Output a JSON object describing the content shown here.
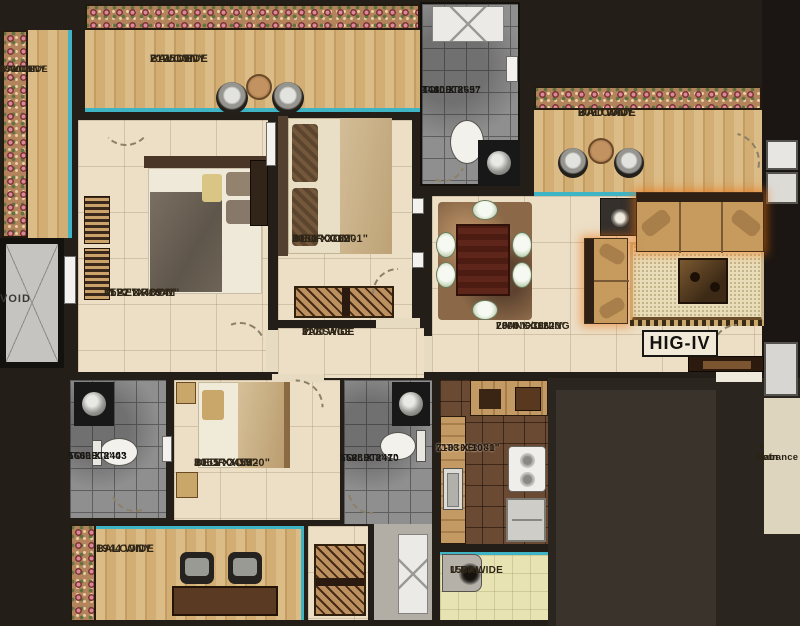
{
  "unit": {
    "type_label": "HIG-IV"
  },
  "entrance": {
    "arrow": "▲",
    "line1": "Main",
    "line2": "Entrance",
    "line3": "Door"
  },
  "rooms": {
    "balcony_top_left": {
      "name": "BALCONY",
      "dim_mm": "2125 WIDE",
      "dim_ft": "7' WIDE"
    },
    "balcony_left": {
      "name": "BALCONY",
      "dim_mm": "1500 WIDE",
      "dim_ft": "5' WIDE"
    },
    "balcony_top_right": {
      "name": "BALCONY",
      "dim_mm": "2070 WIDE",
      "dim_ft": "6'-9\" WIDE"
    },
    "balcony_bottom": {
      "name": "BALCONY",
      "dim_mm": "1944 WIDE"
    },
    "utility_balcony": {
      "name": "U.BAL.",
      "dim_mm": "1500 WIDE"
    },
    "toilet_top": {
      "name": "TOILET",
      "dim_mm": "1410 X 2657",
      "dim_ft": "4'-8\" X 8'-9\""
    },
    "toilet_left": {
      "name": "TOILET",
      "dim_mm": "1669 X 2443",
      "dim_ft": "5'-6\" X 8'-0\""
    },
    "toilet_middle": {
      "name": "TOILET",
      "dim_mm": "1568 X 2470",
      "dim_ft": "5'-2\" X 8'-1\""
    },
    "master_bedroom": {
      "name": "M.BEDROOM",
      "dim_mm": "3522 X 4894",
      "dim_ft": "11'-7\" X 16'-1\""
    },
    "bedroom_top": {
      "name": "BEDROOM",
      "dim_mm": "3080 X 3690",
      "dim_ft": "10'-1\" X 12'-1\""
    },
    "bedroom_bottom": {
      "name": "BEDROOM",
      "dim_mm": "3065 X 4582",
      "dim_ft": "10'-1\" X 15'-0\""
    },
    "passage": {
      "name": "PASSAGE",
      "dim_mm": "1100 WIDE",
      "dim_ft": "3'-7\" WIDE"
    },
    "living_dining": {
      "name": "LIVING/DINING",
      "dim_mm": "7008 X 3662",
      "dim_ft": "23'-0\" X 12'-0\""
    },
    "kitchen": {
      "name": "KITCHEN",
      "dim_mm": "2133 X 3080",
      "dim_ft": "7'-0\" X 10'-1\""
    },
    "void": {
      "name": "VOID"
    }
  },
  "colors": {
    "teal_accent": "#3fb4c4",
    "wall": "#16120e",
    "floor_beige": "#ecdfc6",
    "balcony_wood": "#d3ab72",
    "tile_gray": "#8f8f8f",
    "kitchen_brown": "#6a4a32"
  }
}
